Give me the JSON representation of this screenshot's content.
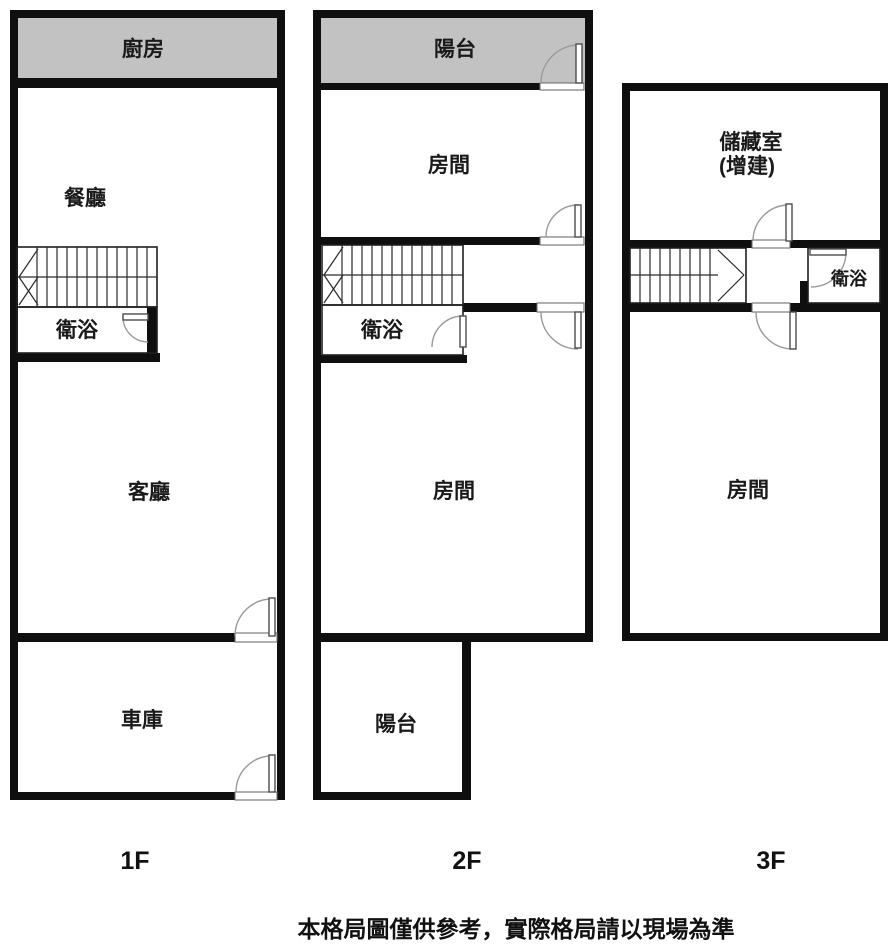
{
  "page": {
    "disclaimer": "本格局圖僅供參考，實際格局請以現場為準"
  },
  "colors": {
    "wall": "#0f0f0f",
    "balcony_fill": "#c2c2c2",
    "thin_line": "#1f1f1f",
    "door_arc": "#9a9a9a",
    "background": "#ffffff"
  },
  "floors": [
    {
      "id": "1f",
      "label": "1F",
      "rooms": {
        "kitchen": "廚房",
        "dining": "餐廳",
        "bathroom": "衛浴",
        "living": "客廳",
        "garage": "車庫"
      }
    },
    {
      "id": "2f",
      "label": "2F",
      "rooms": {
        "balcony_top": "陽台",
        "room_upper": "房間",
        "bathroom": "衛浴",
        "room_lower": "房間",
        "balcony_bottom": "陽台"
      }
    },
    {
      "id": "3f",
      "label": "3F",
      "rooms": {
        "storage_line1": "儲藏室",
        "storage_line2": "(增建)",
        "bathroom": "衛浴",
        "room": "房間"
      }
    }
  ]
}
